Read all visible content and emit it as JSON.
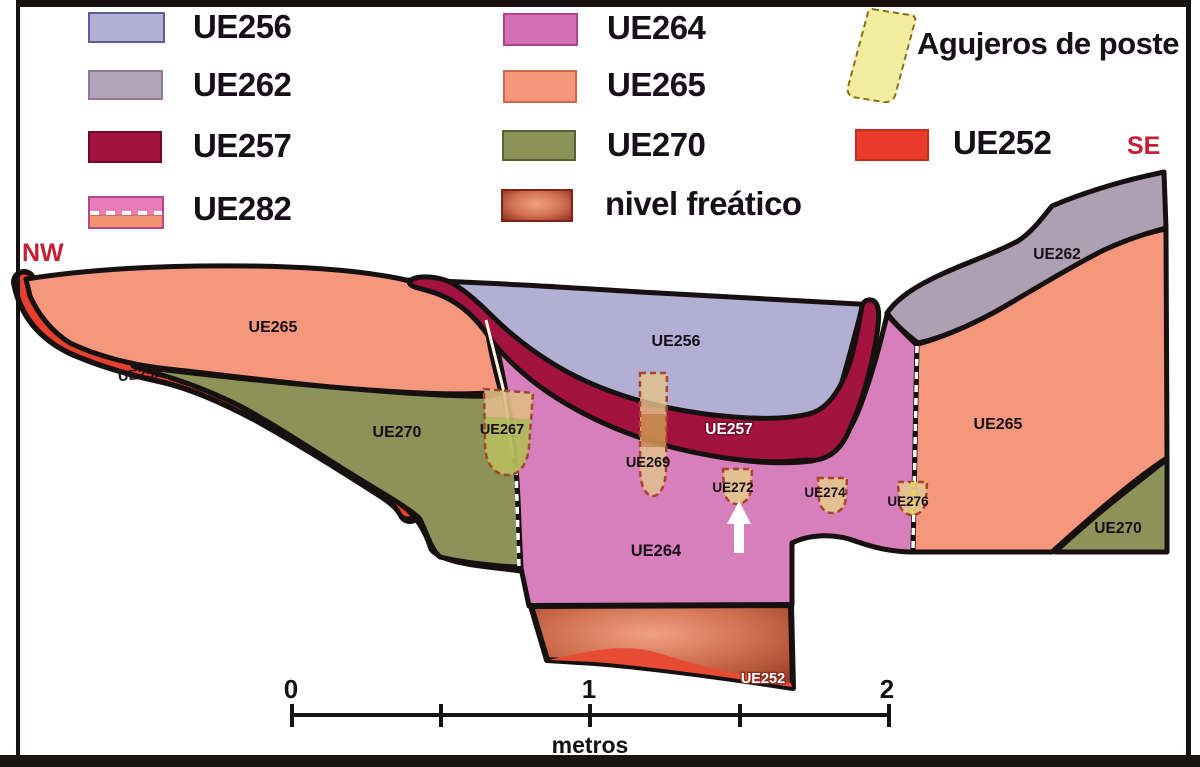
{
  "title": "Stratigraphic section NW-SE",
  "compass": {
    "nw": "NW",
    "se": "SE",
    "color": "#c41f32"
  },
  "legend": {
    "items": [
      {
        "label": "UE256",
        "color": "#b2aed4"
      },
      {
        "label": "UE262",
        "color": "#b4a4ba"
      },
      {
        "label": "UE257",
        "color": "#a31240"
      },
      {
        "label": "UE282",
        "color_top": "#e77cb8",
        "color_bottom": "#f29170"
      },
      {
        "label": "UE264",
        "color": "#d36fb5"
      },
      {
        "label": "UE265",
        "color": "#f4967c"
      },
      {
        "label": "UE270",
        "color": "#8b9359"
      },
      {
        "label": "nivel freático",
        "gradient_center": "#f0a183",
        "gradient_edge": "#8c2e1f"
      },
      {
        "label": "Agujeros de poste",
        "color": "#f2ee9f"
      },
      {
        "label": "UE252",
        "color": "#ea3b2d"
      }
    ]
  },
  "section": {
    "labels": {
      "ue265_left": "UE265",
      "ue252_left": "UE252",
      "ue270_left": "UE270",
      "ue267": "UE267",
      "ue256": "UE256",
      "ue257": "UE257",
      "ue269": "UE269",
      "ue272": "UE272",
      "ue274": "UE274",
      "ue276": "UE276",
      "ue264": "UE264",
      "ue252_bottom": "UE252",
      "ue265_right": "UE265",
      "ue262": "UE262",
      "ue270_right": "UE270"
    },
    "colors": {
      "ue256": "#b2aed4",
      "ue262": "#ae9fb2",
      "ue257": "#a31240",
      "ue264": "#d77fba",
      "ue265": "#f4977c",
      "ue270": "#8b9359",
      "ue252": "#e8402f",
      "posthole_fill": "#e2c38c",
      "posthole_border": "#a8422b",
      "outline": "#161110"
    }
  },
  "scale": {
    "ticks": [
      "0",
      "1",
      "2"
    ],
    "unit": "metros"
  }
}
